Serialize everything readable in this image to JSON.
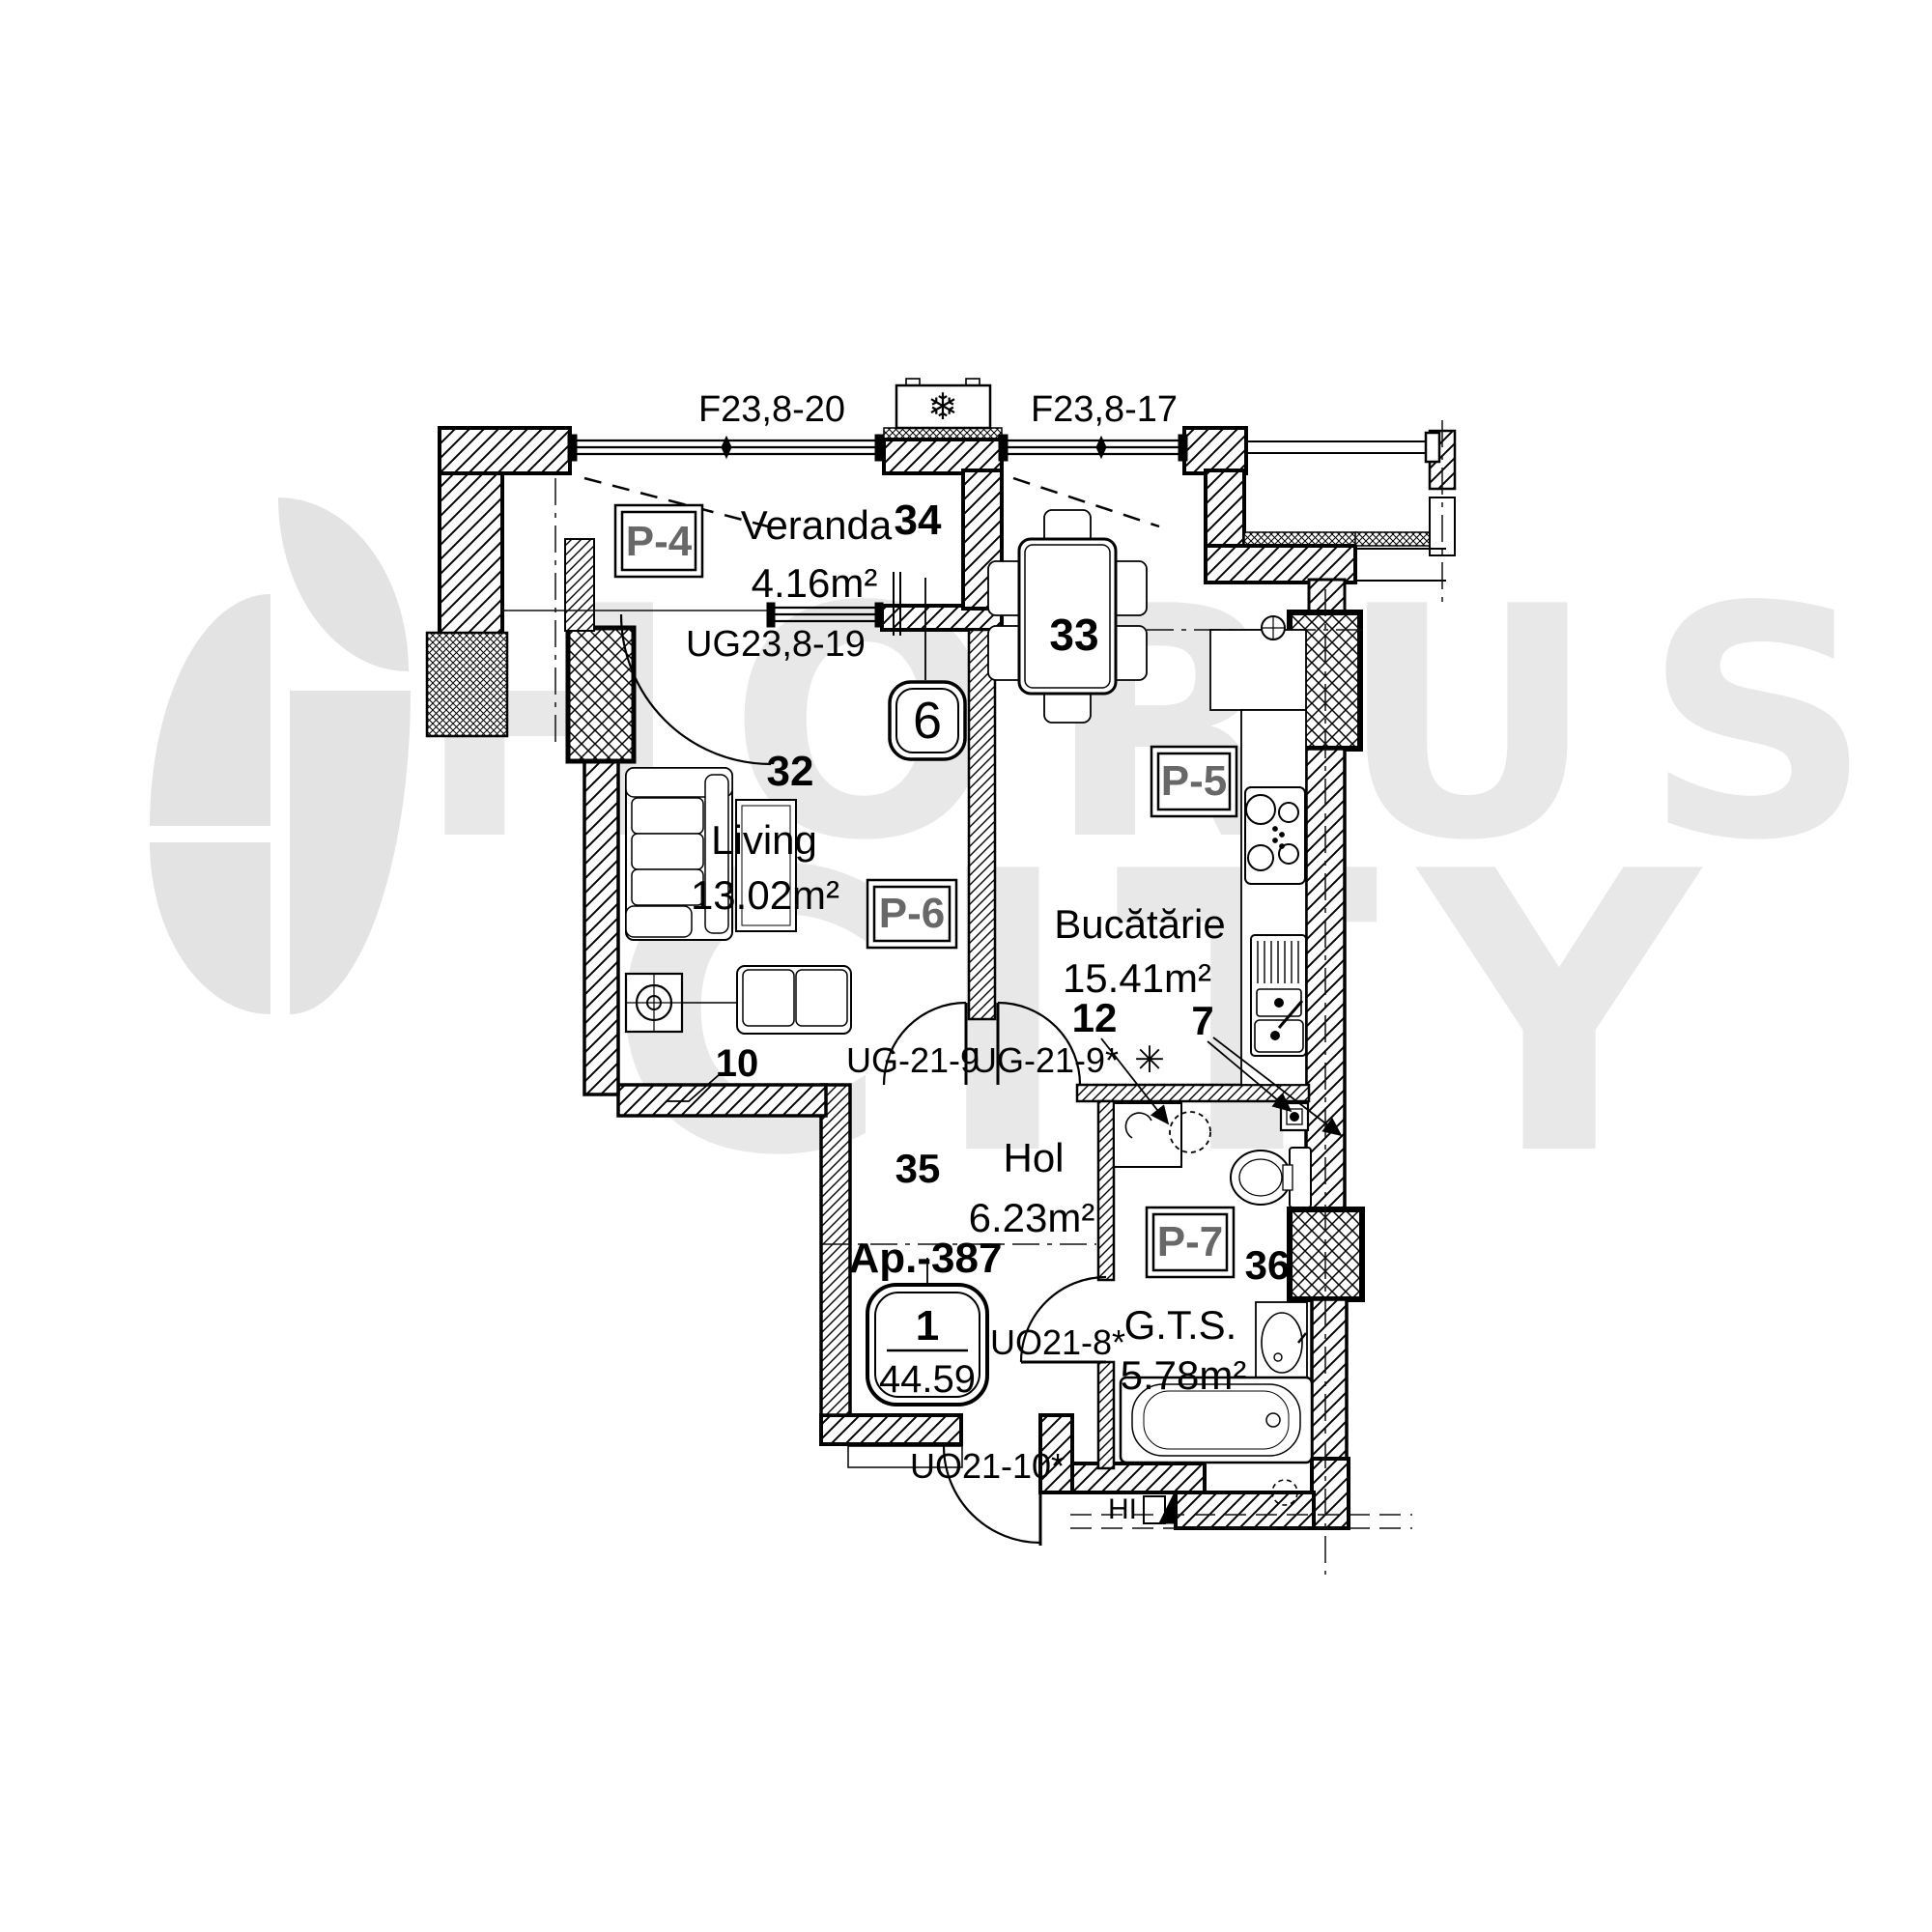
{
  "watermark": {
    "line1": "HORUS",
    "line2": "CITY"
  },
  "apartment": {
    "label": "Ap.-387",
    "badge_number": "1",
    "badge_total_area": "44.59"
  },
  "rooms": {
    "veranda": {
      "number": "34",
      "name": "Veranda",
      "area": "4.16m²"
    },
    "living": {
      "number": "32",
      "name": "Living",
      "area": "13.02m²"
    },
    "kitchen": {
      "number": "33",
      "name": "Bucătărie",
      "area": "15.41m²"
    },
    "hall": {
      "number": "35",
      "name": "Hol",
      "area": "6.23m²"
    },
    "bathroom": {
      "number": "36",
      "name": "G.T.S.",
      "area": "5.78m²"
    }
  },
  "openings": {
    "window_top_left": "F23,8-20",
    "window_top_right": "F23,8-17",
    "veranda_door": "UG23,8-19",
    "living_hall_door": "UG-21-9",
    "kitchen_hall_door": "UG-21-9*",
    "bathroom_door": "UO21-8*",
    "entrance_door": "UO21-10*"
  },
  "markers": {
    "p4": "P-4",
    "p5": "P-5",
    "p6": "P-6",
    "p7": "P-7",
    "circle_badge": "6",
    "note_10": "10",
    "note_12": "12",
    "note_7": "7",
    "hydrant": "HI",
    "asterisk": "✳",
    "snowflake": "❄"
  }
}
